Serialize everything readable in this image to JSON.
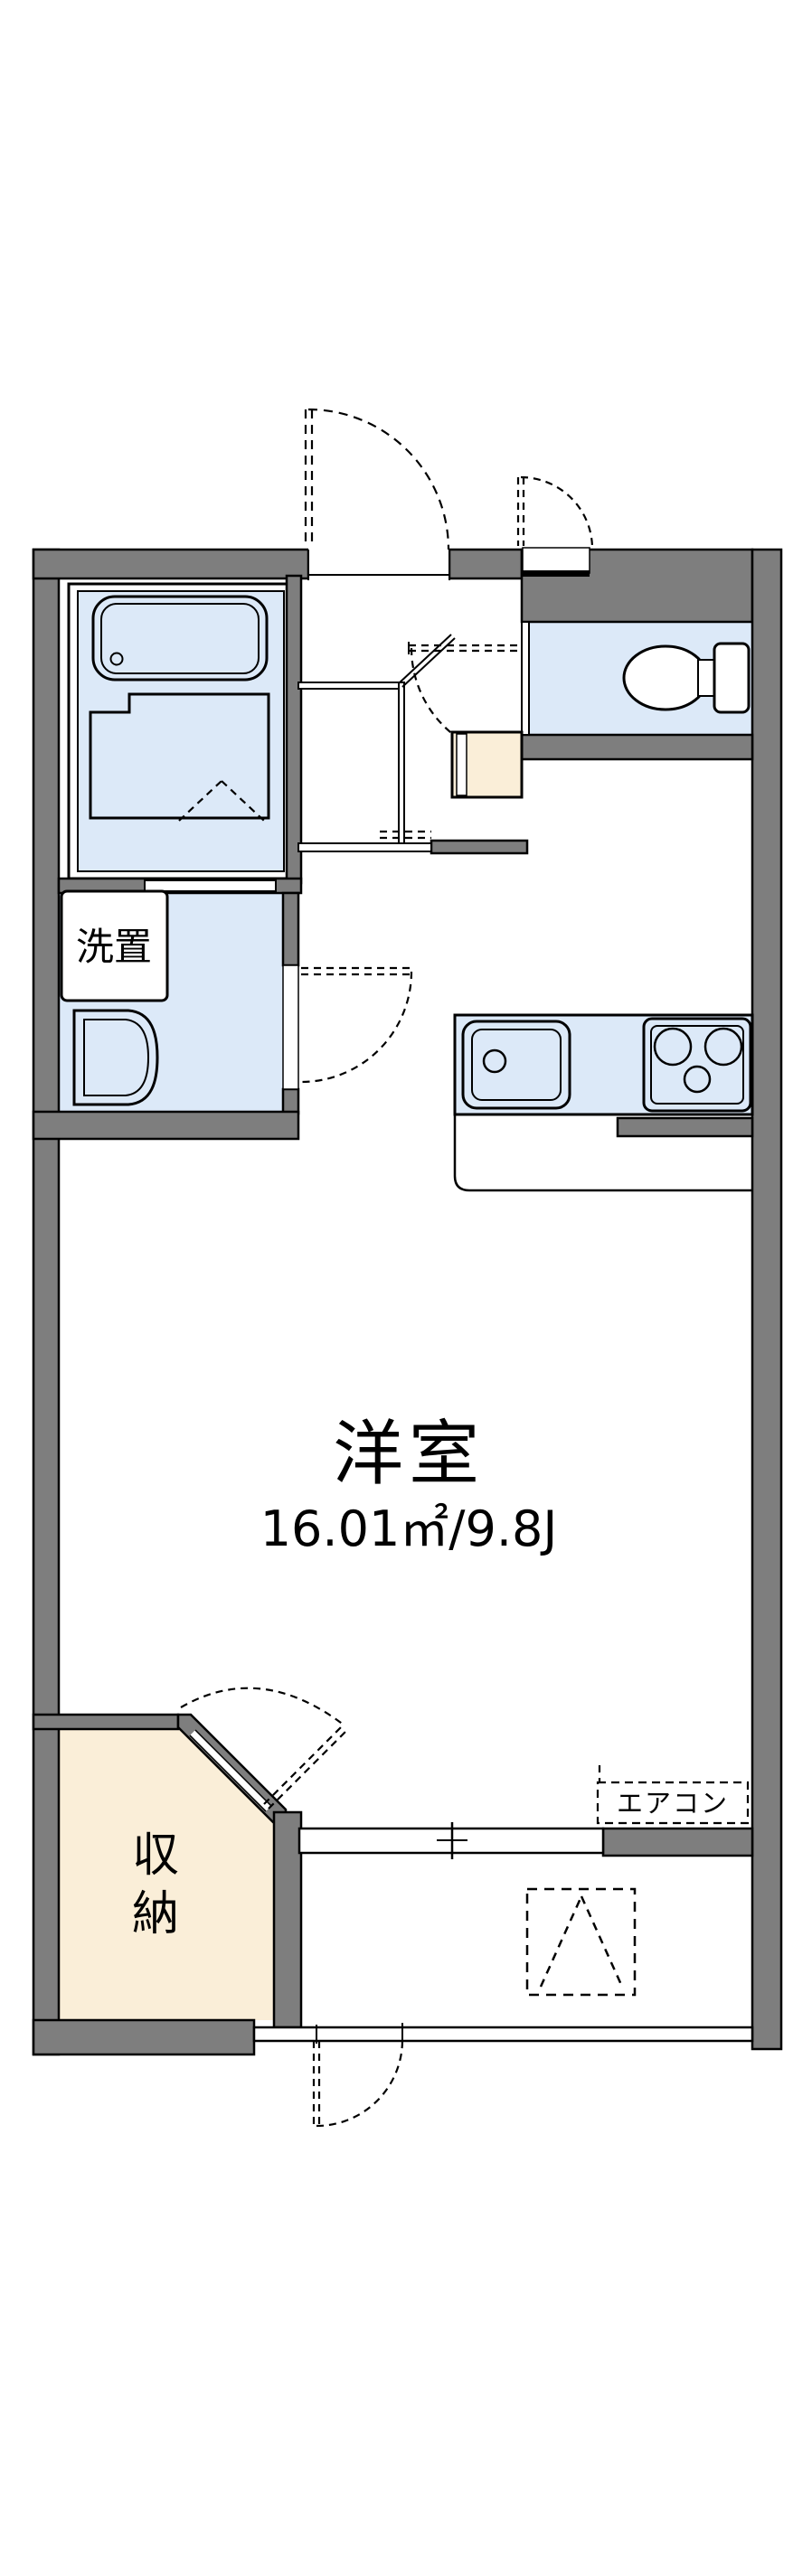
{
  "plan": {
    "main_room": {
      "label": "洋室",
      "area": "16.01㎡/9.8J"
    },
    "storage": {
      "char1": "収",
      "char2": "納"
    },
    "washer": {
      "label": "洗置"
    },
    "aircon": {
      "label": "エアコン"
    },
    "colors": {
      "wall": "#7e7e7e",
      "room_fill": "#dce9f8",
      "storage_fill": "#faeed8",
      "line": "#000000"
    }
  }
}
